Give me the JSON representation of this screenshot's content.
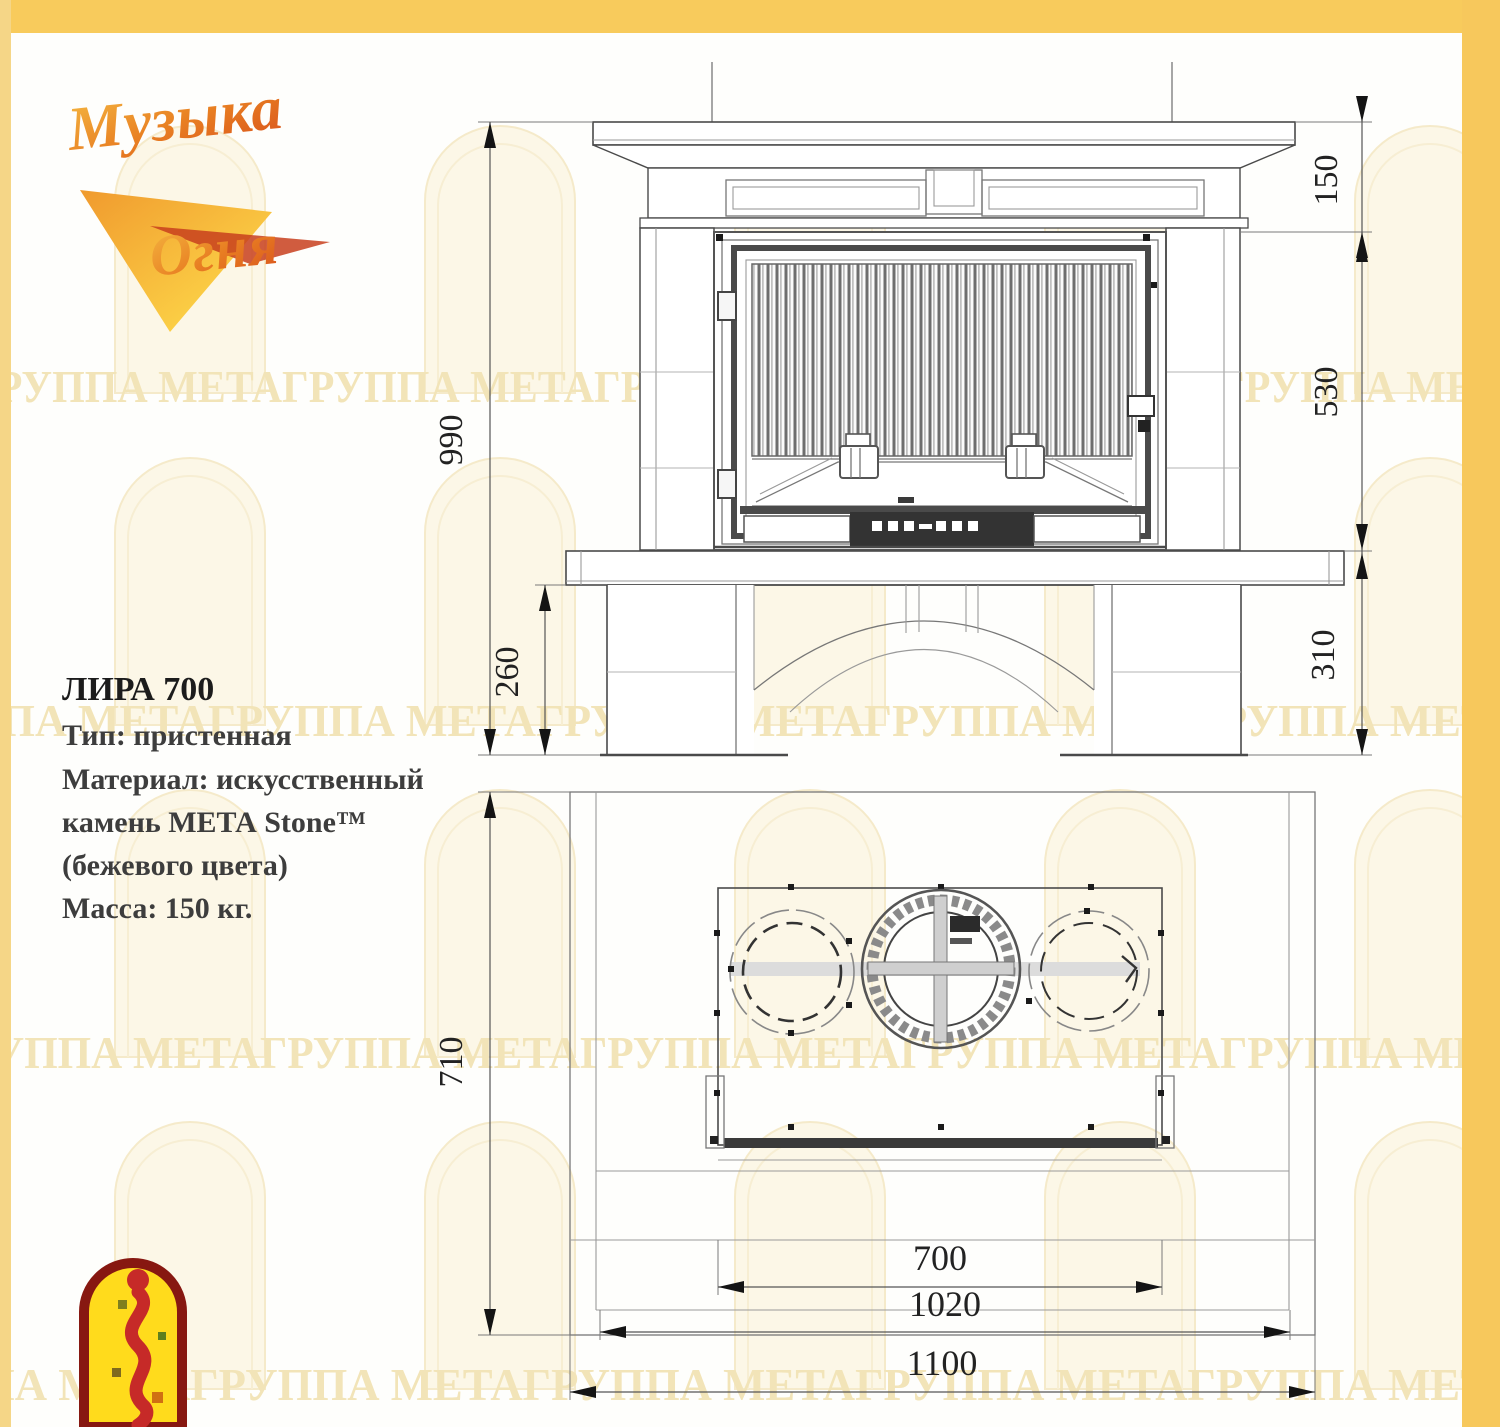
{
  "logo": {
    "word1": "Музыка",
    "word2": "Огня"
  },
  "product": {
    "title": "ЛИРА 700",
    "line_type": "Тип: пристенная",
    "line_material_1": "Материал: искусственный",
    "line_material_2": "камень МЕТА Stone™",
    "line_material_3": "(бежевого цвета)",
    "line_mass": "Масса: 150 кг."
  },
  "front_view": {
    "dim_overall_height": "990",
    "dim_mantel_height": "150",
    "dim_firebox_height": "530",
    "dim_base_height": "260",
    "dim_plinth_height": "310"
  },
  "plan_view": {
    "dim_depth": "710",
    "dim_firebox_width": "700",
    "dim_body_width": "1020",
    "dim_overall_width": "1100"
  },
  "watermark": {
    "row1": "ГРУППА МЕТАГРУППА МЕТАГРУППА МЕТАГРУППА МЕТАГРУППА МЕТА",
    "row2": "ГРУППА МЕТАГРУППА МЕТАГРУППА МЕТАГРУППА МЕТАГРУППА МЕТА",
    "row3": "ГРУППА МЕТАГРУППА МЕТАГРУППА МЕТАГРУППА МЕТАГРУППА МЕТА",
    "row4": "ПА МЕТАГРУППА МЕТАГРУППА МЕТАГРУППА МЕТАГРУППА МЕТА"
  },
  "colors": {
    "border": "#F7C85C",
    "logo_orange": "#E4731F",
    "emblem_red": "#8E1B12"
  }
}
